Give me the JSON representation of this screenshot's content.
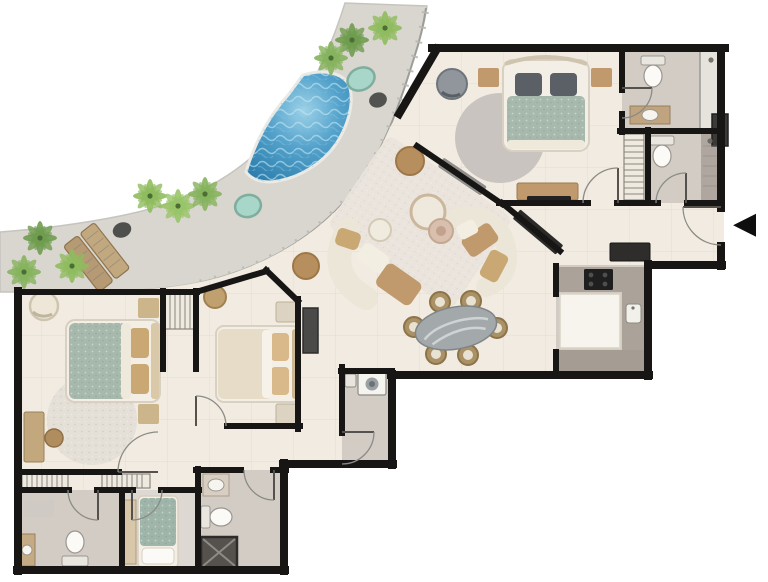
{
  "palette": {
    "wall": "#171615",
    "floor": "#f1ebe1",
    "terrace": "#d9d6cf",
    "grayroom": "#d2ccc5",
    "graydark": "#a9a098",
    "pool_deep": "#2e7fae",
    "pool_mid": "#55a3cc",
    "pool_light": "#9ed2e8",
    "plunge": "#a8d6c9",
    "plant": "#6f9c4f",
    "plant_light": "#8fbc5e",
    "tan": "#c09a6d",
    "wood": "#b59a73",
    "cream": "#ece5d6",
    "sage": "#a7b8ac",
    "grayrug": "#c9c4bf",
    "speckle_rug": "#e4dfd7",
    "dark": "#3c3c3a",
    "tv": "#222222",
    "white": "#fbfaf7",
    "marble": "#a3a8ab"
  },
  "entry": {
    "arrow_glyph": "◀"
  },
  "plan": {
    "label": "apartment floor plan with curved pool terrace",
    "rooms": [
      {
        "id": "terrace",
        "label": "pool terrace",
        "features": [
          "curved pool",
          "two plunge pools",
          "double sun lounger",
          "palm plants",
          "poufs",
          "railing"
        ]
      },
      {
        "id": "living-room",
        "label": "living room",
        "features": [
          "curved sofa",
          "second curved sofa",
          "two round coffee tables",
          "floor poufs",
          "area rug",
          "media bench"
        ]
      },
      {
        "id": "dining-area",
        "label": "dining area",
        "features": [
          "oval marble table",
          "six chairs"
        ]
      },
      {
        "id": "kitchen",
        "label": "kitchen",
        "features": [
          "u-shaped counter",
          "island",
          "cooktop",
          "sink",
          "tv console outside"
        ]
      },
      {
        "id": "master-bedroom",
        "label": "master bedroom",
        "features": [
          "double bed",
          "two nightstands",
          "round rug",
          "armchair",
          "dresser with tv"
        ]
      },
      {
        "id": "master-bathroom",
        "label": "bathroom 1",
        "features": [
          "toilet",
          "vanity",
          "walk-in shower",
          "cabinet"
        ]
      },
      {
        "id": "guest-bathroom",
        "label": "bathroom 2",
        "features": [
          "toilet",
          "shower",
          "slatted wardrobe"
        ]
      },
      {
        "id": "entry-hall",
        "label": "entry hall",
        "features": [
          "entrance door",
          "entry direction arrow"
        ]
      },
      {
        "id": "bedroom-2",
        "label": "bedroom 2",
        "features": [
          "double bed",
          "two nightstands",
          "round rug",
          "desk with chair",
          "armchair"
        ]
      },
      {
        "id": "bedroom-3",
        "label": "bedroom 3",
        "features": [
          "double bed",
          "two nightstands",
          "wardrobe",
          "pouf"
        ]
      },
      {
        "id": "laundry",
        "label": "laundry room",
        "features": [
          "washing machine",
          "small sink"
        ]
      },
      {
        "id": "bathroom-3",
        "label": "bathroom 3",
        "features": [
          "vanity",
          "toilet",
          "dark shower cabin"
        ]
      },
      {
        "id": "staff-room",
        "label": "small bedroom",
        "features": [
          "single bed",
          "side vanity"
        ]
      },
      {
        "id": "bathroom-4",
        "label": "bathroom 4",
        "features": [
          "toilet",
          "vanity",
          "mat"
        ]
      },
      {
        "id": "hallway",
        "label": "hallway",
        "features": [
          "slatted closets",
          "doors"
        ]
      }
    ]
  }
}
